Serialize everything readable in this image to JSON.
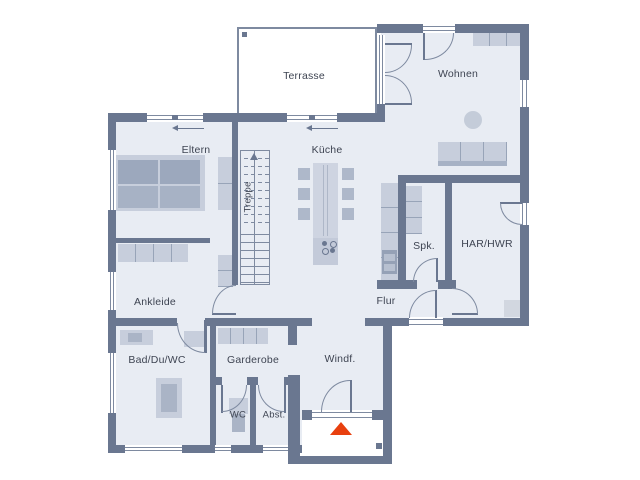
{
  "plan": {
    "rooms": [
      {
        "id": "terrasse",
        "label": "Terrasse"
      },
      {
        "id": "wohnen",
        "label": "Wohnen"
      },
      {
        "id": "eltern",
        "label": "Eltern"
      },
      {
        "id": "kueche",
        "label": "Küche"
      },
      {
        "id": "treppe",
        "label": "Treppe"
      },
      {
        "id": "spk",
        "label": "Spk."
      },
      {
        "id": "har_hwr",
        "label": "HAR/HWR"
      },
      {
        "id": "ankleide",
        "label": "Ankleide"
      },
      {
        "id": "flur",
        "label": "Flur"
      },
      {
        "id": "bad_du_wc",
        "label": "Bad/Du/WC"
      },
      {
        "id": "garderobe",
        "label": "Garderobe"
      },
      {
        "id": "windfang",
        "label": "Windf."
      },
      {
        "id": "wc",
        "label": "WC"
      },
      {
        "id": "abstell",
        "label": "Abst."
      }
    ],
    "markers": {
      "entrance_marker": "red-triangle-up",
      "stair_direction": "arrow-up",
      "window_opening_direction": "arrow-left"
    },
    "colors": {
      "wall": "#6a7790",
      "floor": "#e8ecf3",
      "outline": "#7e8aa0",
      "furniture_light": "#c7cedc",
      "furniture_medium": "#aab4c6",
      "furniture_dark": "#9ca8bd",
      "entrance_accent": "#e8400f",
      "label_text": "#3e4452",
      "background": "#ffffff"
    }
  }
}
